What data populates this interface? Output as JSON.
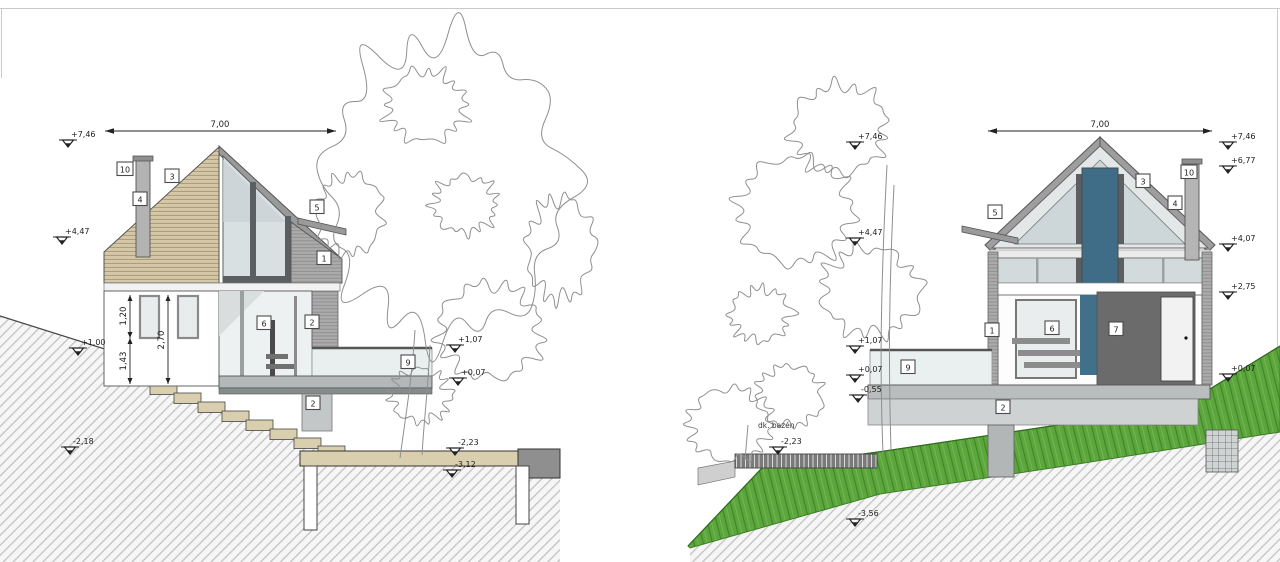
{
  "sheet": {
    "background": "#ffffff",
    "edge_color": "#c9c9c9"
  },
  "colors": {
    "wood": "#d5c8a8",
    "wood_line": "#ab9a76",
    "roof_grey": "#9a9a9a",
    "slat_grey": "#ababab",
    "glass": "#d9e0e2",
    "glass_pale": "#eef1f1",
    "dark_window": "#3f6c86",
    "door_dark": "#6b6b6b",
    "slab_grey": "#b4b8b8",
    "beige": "#d9cfae",
    "grass_green": "#5ca63d",
    "earth_hatch_line": "#c2c2c2",
    "tree_line": "#8f8f8f"
  },
  "left_view": {
    "width_dim": "7,00",
    "heights": {
      "h1": "1,20",
      "h2": "2,70",
      "h3": "1,43"
    },
    "levels_left": [
      "+7,46",
      "+4,47",
      "+1,00",
      "-2,18"
    ],
    "levels_right": [
      "+1,07",
      "+0,07",
      "-2,23",
      "-3,12"
    ],
    "tags": {
      "t10": "10",
      "t4": "4",
      "t3": "3",
      "t5": "5",
      "t1": "1",
      "t6": "6",
      "t2a": "2",
      "t9": "9",
      "t2b": "2"
    }
  },
  "right_view": {
    "width_dim": "7,00",
    "levels_left": [
      "+7,46",
      "+4,47",
      "+1,07",
      "+0,07",
      "-0,55"
    ],
    "levels_right": [
      "+7,46",
      "+6,77",
      "+4,07",
      "+2,75",
      "+0,07"
    ],
    "pool": {
      "label": "dk. bazén",
      "value": "-2,23"
    },
    "bottom_level": "-3,56",
    "tags": {
      "t5": "5",
      "t3": "3",
      "t10": "10",
      "t4": "4",
      "t1": "1",
      "t6": "6",
      "t7": "7",
      "t9": "9",
      "t2": "2"
    }
  }
}
